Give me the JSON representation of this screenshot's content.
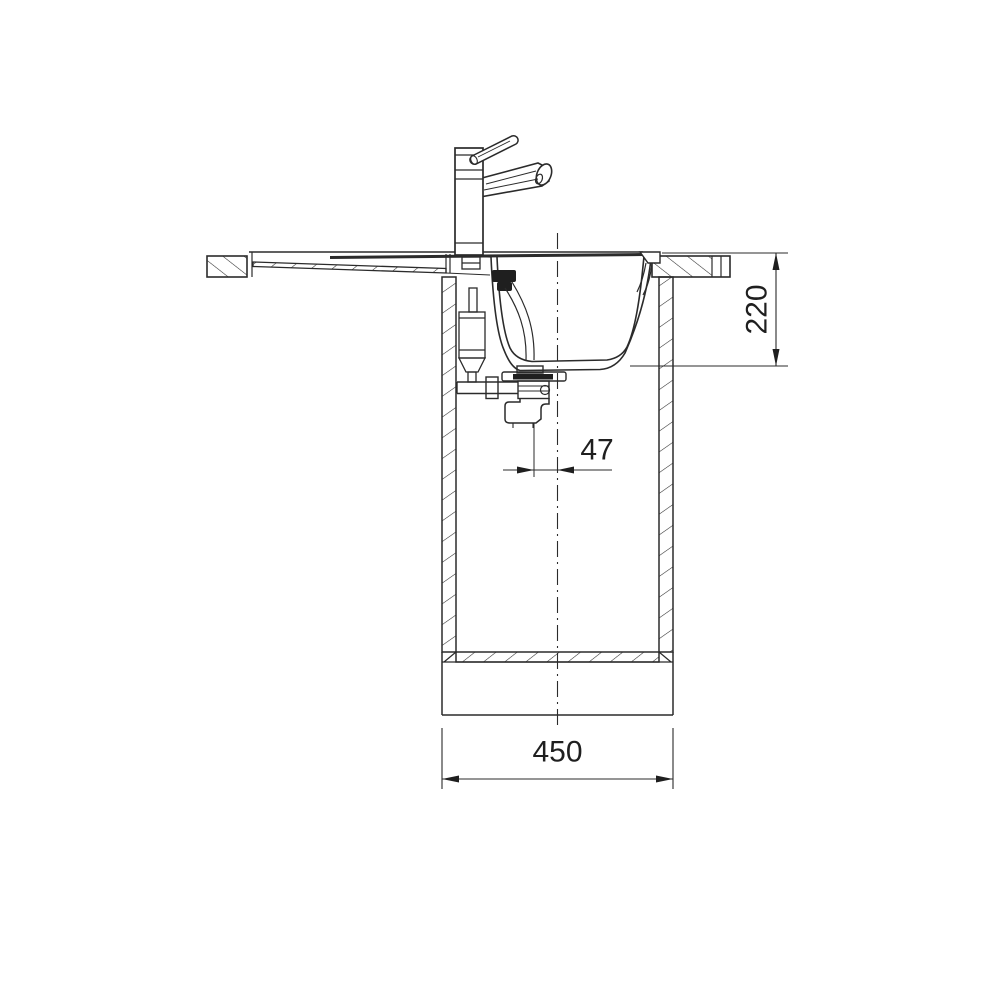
{
  "drawing": {
    "subject": "kitchen-sink-installation-section",
    "dimension_labels": {
      "depth": "220",
      "drain_offset": "47",
      "width": "450"
    },
    "colors": {
      "line": "#2b2b2b",
      "dim_text": "#1f1f1f",
      "background": "#ffffff"
    }
  }
}
